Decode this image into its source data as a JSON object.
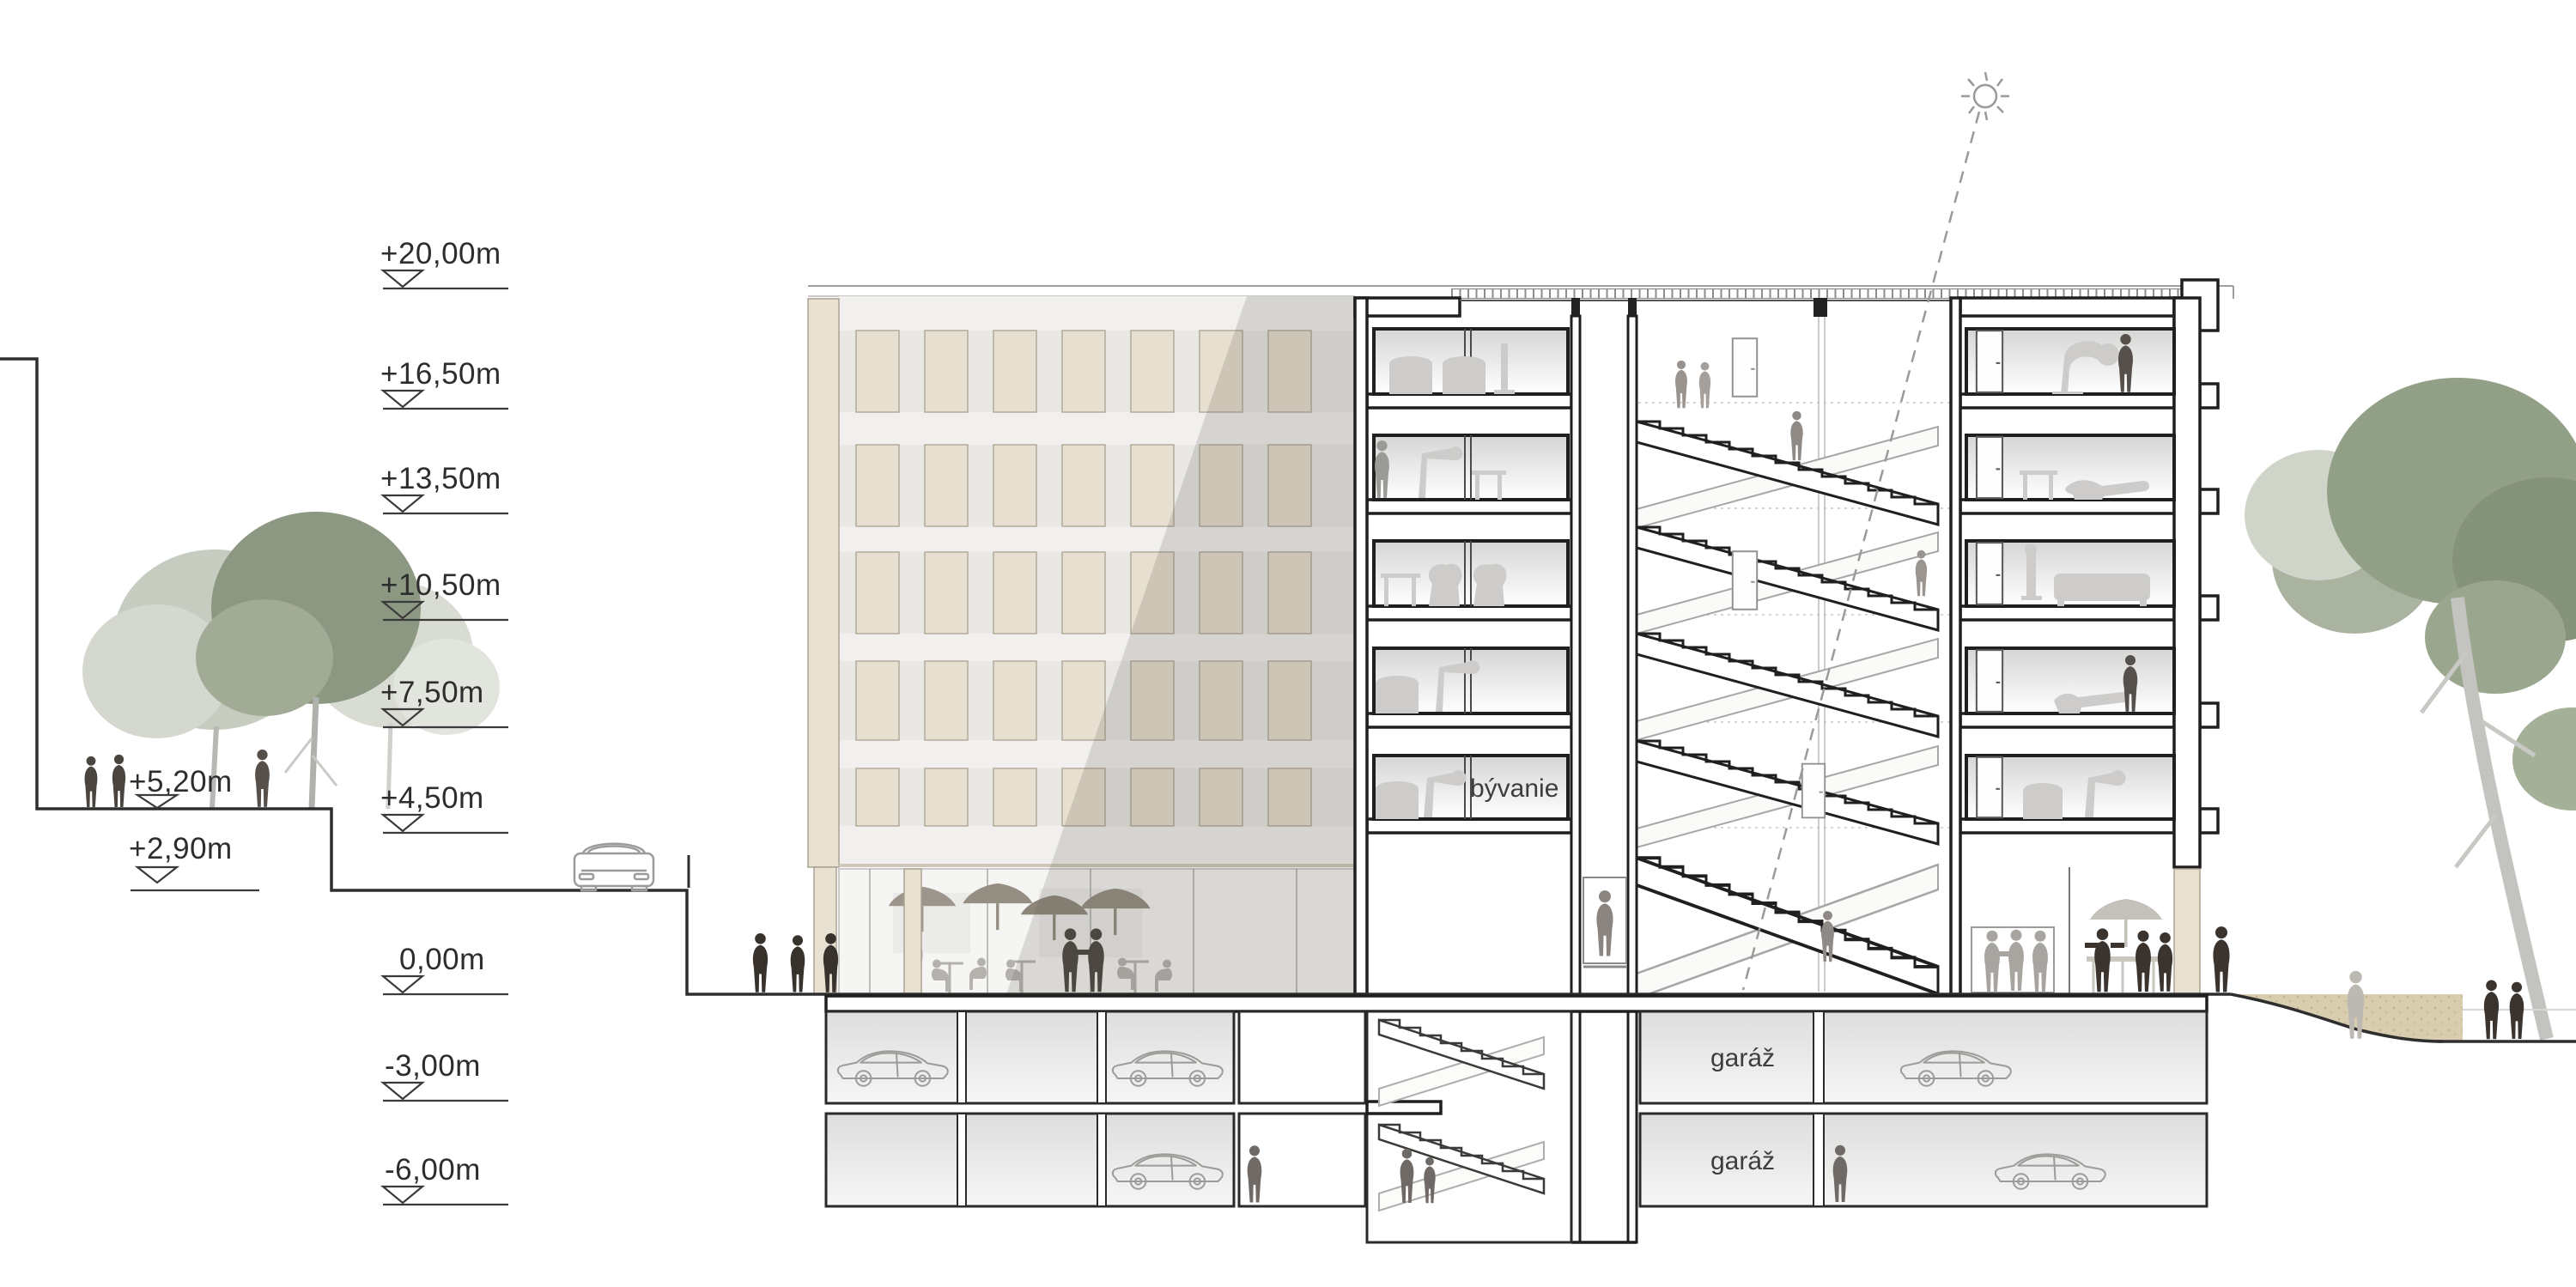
{
  "drawing": {
    "kind": "architectural-building-section",
    "language": "Slovak"
  },
  "levels": [
    {
      "label": "+20,00m"
    },
    {
      "label": "+16,50m"
    },
    {
      "label": "+13,50m"
    },
    {
      "label": "+10,50m"
    },
    {
      "label": "+7,50m"
    },
    {
      "label": "+4,50m"
    },
    {
      "label": "0,00m"
    },
    {
      "label": "-3,00m"
    },
    {
      "label": "-6,00m"
    },
    {
      "label": "+5,20m"
    },
    {
      "label": "+2,90m"
    }
  ],
  "rooms": {
    "living": "bývanie",
    "garage_upper": "garáž",
    "garage_lower": "garáž"
  },
  "icons": {
    "sun": "sun-icon"
  },
  "colors": {
    "paper": "#ffffff",
    "cut_line": "#1f1f1f",
    "ground_line": "#2e2e2e",
    "facade_panel": "#e7dfcf",
    "facade_pier": "#e8e1d2",
    "earth_fill": "#d9cdb0",
    "tree_green": "#8d9883",
    "tree_light": "#ccd1c6",
    "people_dark": "#3a332e",
    "people_light": "#b3afab",
    "room_gradient_top": "#d5d5d4",
    "shadow_overlay": "rgba(105,100,92,0.20)"
  }
}
